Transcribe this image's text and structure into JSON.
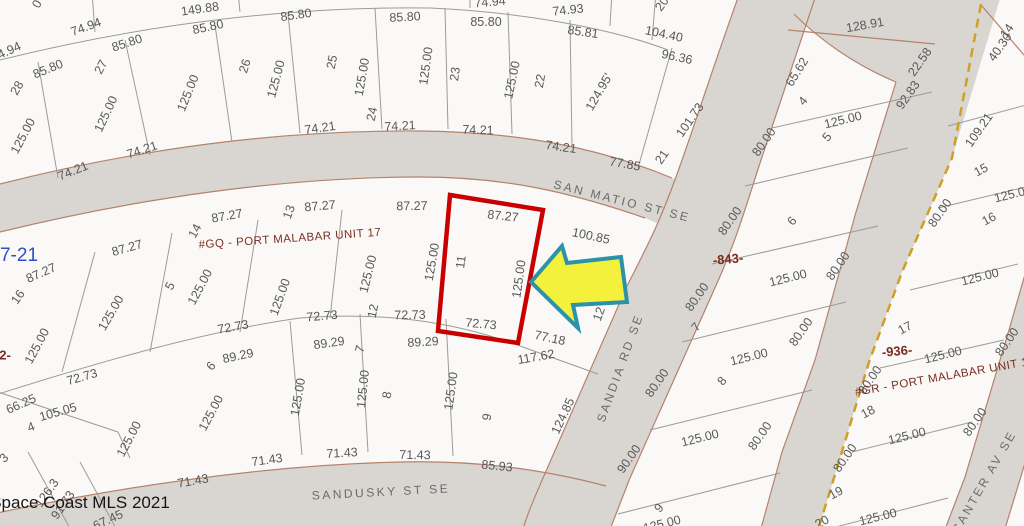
{
  "map": {
    "credit": "Space Coast MLS 2021",
    "plat_page_ref": "7-21",
    "streets": [
      "SAN MATIO ST SE",
      "SANDIA RD SE",
      "SANDUSKY ST SE",
      "CANTER AV SE"
    ],
    "subdivisions": [
      "#GQ - PORT MALABAR UNIT 17",
      "#GR - PORT MALABAR UNIT 18"
    ],
    "block_numbers": [
      "-843-",
      "-936-"
    ],
    "highlight": {
      "lot_number": "11",
      "top": "87.27",
      "left": "125.00",
      "right": "125.00",
      "bottom": "72.73"
    },
    "colors": {
      "parcel": "#faf9f7",
      "street": "#d9d6d2",
      "street_edge": "#b5826b",
      "highlight_red": "#c90000",
      "arrow_fill": "#f4f13c",
      "arrow_stroke": "#2c92a7",
      "boundary_dash": "#cf9f26"
    }
  },
  "labels": [
    {
      "t": "0",
      "x": 37,
      "y": 4,
      "r": -60
    },
    {
      "t": "149.88",
      "x": 200,
      "y": 9,
      "r": -8
    },
    {
      "t": "74.94",
      "x": 86,
      "y": 27,
      "r": -20
    },
    {
      "t": "74.94",
      "x": 490,
      "y": 2,
      "r": -5
    },
    {
      "t": "74.93",
      "x": 568,
      "y": 10,
      "r": -6
    },
    {
      "t": "85.81",
      "x": 583,
      "y": 32,
      "r": 8
    },
    {
      "t": "104.40",
      "x": 664,
      "y": 34,
      "r": 12
    },
    {
      "t": "96.36",
      "x": 677,
      "y": 57,
      "r": 12
    },
    {
      "t": "74.94",
      "x": 6,
      "y": 52,
      "r": -25
    },
    {
      "t": "85.80",
      "x": 48,
      "y": 69,
      "r": -22
    },
    {
      "t": "85.80",
      "x": 127,
      "y": 43,
      "r": -18
    },
    {
      "t": "85.80",
      "x": 208,
      "y": 27,
      "r": -12
    },
    {
      "t": "85.80",
      "x": 296,
      "y": 15,
      "r": -8
    },
    {
      "t": "85.80",
      "x": 405,
      "y": 17,
      "r": -3
    },
    {
      "t": "85.80",
      "x": 486,
      "y": 22,
      "r": 0
    },
    {
      "t": "28",
      "x": 17,
      "y": 88,
      "r": -60,
      "k": "lot"
    },
    {
      "t": "27",
      "x": 101,
      "y": 67,
      "r": -62,
      "k": "lot"
    },
    {
      "t": "26",
      "x": 245,
      "y": 66,
      "r": -72,
      "k": "lot"
    },
    {
      "t": "25",
      "x": 332,
      "y": 62,
      "r": -78,
      "k": "lot"
    },
    {
      "t": "24",
      "x": 372,
      "y": 114,
      "r": -78,
      "k": "lot"
    },
    {
      "t": "23",
      "x": 455,
      "y": 74,
      "r": -82,
      "k": "lot"
    },
    {
      "t": "22",
      "x": 540,
      "y": 81,
      "r": -80,
      "k": "lot"
    },
    {
      "t": "21",
      "x": 662,
      "y": 157,
      "r": -55,
      "k": "lot"
    },
    {
      "t": "20",
      "x": 662,
      "y": 4,
      "r": -55,
      "k": "lot"
    },
    {
      "t": "125.00",
      "x": 23,
      "y": 136,
      "r": -62
    },
    {
      "t": "125.00",
      "x": 106,
      "y": 114,
      "r": -65
    },
    {
      "t": "125.00",
      "x": 188,
      "y": 93,
      "r": -68
    },
    {
      "t": "125.00",
      "x": 276,
      "y": 79,
      "r": -75
    },
    {
      "t": "125.00",
      "x": 362,
      "y": 77,
      "r": -80
    },
    {
      "t": "125.00",
      "x": 426,
      "y": 66,
      "r": -82
    },
    {
      "t": "125.00",
      "x": 512,
      "y": 80,
      "r": -78
    },
    {
      "t": "124.95'",
      "x": 599,
      "y": 92,
      "r": -60
    },
    {
      "t": "101.73",
      "x": 690,
      "y": 120,
      "r": -55
    },
    {
      "t": "77.85",
      "x": 625,
      "y": 164,
      "r": 10
    },
    {
      "t": "74.21",
      "x": 73,
      "y": 171,
      "r": -22
    },
    {
      "t": "74.21",
      "x": 142,
      "y": 150,
      "r": -18
    },
    {
      "t": "74.21",
      "x": 320,
      "y": 128,
      "r": -8
    },
    {
      "t": "74.21",
      "x": 400,
      "y": 126,
      "r": -3
    },
    {
      "t": "74.21",
      "x": 478,
      "y": 130,
      "r": 2
    },
    {
      "t": "74.21",
      "x": 561,
      "y": 147,
      "r": 8
    },
    {
      "t": "SAN MATIO ST SE",
      "x": 622,
      "y": 201,
      "r": 14,
      "k": "street",
      "n": "street-label-san-matio-st-se"
    },
    {
      "t": "SANDIA RD SE",
      "x": 620,
      "y": 368,
      "r": -70,
      "k": "street",
      "n": "street-label-sandia-rd-se"
    },
    {
      "t": "SANDUSKY ST SE",
      "x": 381,
      "y": 492,
      "r": -3,
      "k": "street",
      "n": "street-label-sandusky-st-se"
    },
    {
      "t": "CANTER AV SE",
      "x": 984,
      "y": 482,
      "r": -60,
      "k": "street",
      "n": "street-label-canter-av-se"
    },
    {
      "t": "7-21",
      "x": 19,
      "y": 256,
      "r": 0,
      "k": "page",
      "n": "plat-page-ref"
    },
    {
      "t": "#GQ - PORT MALABAR UNIT 17",
      "x": 290,
      "y": 239,
      "r": -4,
      "k": "unit",
      "n": "subdivision-label-unit-17"
    },
    {
      "t": "87.27",
      "x": 41,
      "y": 273,
      "r": -24
    },
    {
      "t": "87.27",
      "x": 127,
      "y": 248,
      "r": -16
    },
    {
      "t": "87.27",
      "x": 227,
      "y": 216,
      "r": -10
    },
    {
      "t": "87.27",
      "x": 320,
      "y": 206,
      "r": -5
    },
    {
      "t": "87.27",
      "x": 412,
      "y": 206,
      "r": -1
    },
    {
      "t": "87.27",
      "x": 503,
      "y": 216,
      "r": 6
    },
    {
      "t": "100.85",
      "x": 591,
      "y": 236,
      "r": 12
    },
    {
      "t": "16",
      "x": 18,
      "y": 297,
      "r": -55,
      "k": "lot"
    },
    {
      "t": "5",
      "x": 170,
      "y": 286,
      "r": -62,
      "k": "lot"
    },
    {
      "t": "14",
      "x": 195,
      "y": 231,
      "r": -62,
      "k": "lot"
    },
    {
      "t": "13",
      "x": 289,
      "y": 212,
      "r": -70,
      "k": "lot"
    },
    {
      "t": "12",
      "x": 373,
      "y": 311,
      "r": -78,
      "k": "lot"
    },
    {
      "t": "11",
      "x": 461,
      "y": 262,
      "r": -82,
      "k": "lot",
      "n": "highlight-lot-number"
    },
    {
      "t": "125.00",
      "x": 111,
      "y": 313,
      "r": -60
    },
    {
      "t": "125.00",
      "x": 37,
      "y": 346,
      "r": -62
    },
    {
      "t": "125.00",
      "x": 200,
      "y": 287,
      "r": -62
    },
    {
      "t": "125.00",
      "x": 280,
      "y": 297,
      "r": -70
    },
    {
      "t": "125.00",
      "x": 368,
      "y": 274,
      "r": -76
    },
    {
      "t": "125.00",
      "x": 432,
      "y": 262,
      "r": -80
    },
    {
      "t": "125.00",
      "x": 519,
      "y": 279,
      "r": -82
    },
    {
      "t": "12",
      "x": 599,
      "y": 314,
      "r": -70
    },
    {
      "t": "72.73",
      "x": 82,
      "y": 377,
      "r": -16
    },
    {
      "t": "72.73",
      "x": 233,
      "y": 327,
      "r": -10
    },
    {
      "t": "72.73",
      "x": 322,
      "y": 316,
      "r": -5
    },
    {
      "t": "72.73",
      "x": 410,
      "y": 315,
      "r": -1
    },
    {
      "t": "72.73",
      "x": 481,
      "y": 324,
      "r": 5
    },
    {
      "t": "2-",
      "x": 5,
      "y": 355,
      "r": 0,
      "k": "block",
      "n": "block-number-left-partial"
    },
    {
      "t": "77.18",
      "x": 550,
      "y": 338,
      "r": 12
    },
    {
      "t": "117.62",
      "x": 536,
      "y": 357,
      "r": -10
    },
    {
      "t": "66.25",
      "x": 21,
      "y": 404,
      "r": -24
    },
    {
      "t": "105.05",
      "x": 58,
      "y": 412,
      "r": -16
    },
    {
      "t": "4",
      "x": 31,
      "y": 427,
      "r": -20,
      "k": "lot"
    },
    {
      "t": "3",
      "x": 4,
      "y": 458,
      "r": -45,
      "k": "lot"
    },
    {
      "t": "125.00",
      "x": 129,
      "y": 439,
      "r": -62
    },
    {
      "t": "89.29",
      "x": 238,
      "y": 356,
      "r": -12
    },
    {
      "t": "6",
      "x": 211,
      "y": 366,
      "r": -50,
      "k": "lot"
    },
    {
      "t": "125.00",
      "x": 211,
      "y": 413,
      "r": -62
    },
    {
      "t": "71.43",
      "x": 193,
      "y": 481,
      "r": -10
    },
    {
      "t": "126.3",
      "x": 47,
      "y": 493,
      "r": -55
    },
    {
      "t": "91.73",
      "x": 63,
      "y": 505,
      "r": -55
    },
    {
      "t": "67.45",
      "x": 108,
      "y": 520,
      "r": -25
    },
    {
      "t": "Space Coast MLS 2021",
      "x": 80,
      "y": 503,
      "r": 0,
      "k": "credit",
      "n": "mls-credit"
    },
    {
      "t": "89.29",
      "x": 329,
      "y": 343,
      "r": -8
    },
    {
      "t": "89.29",
      "x": 423,
      "y": 342,
      "r": -3
    },
    {
      "t": "7",
      "x": 360,
      "y": 349,
      "r": -75,
      "k": "lot"
    },
    {
      "t": "8",
      "x": 387,
      "y": 395,
      "r": -80,
      "k": "lot"
    },
    {
      "t": "9",
      "x": 487,
      "y": 417,
      "r": -80,
      "k": "lot"
    },
    {
      "t": "125.00",
      "x": 298,
      "y": 397,
      "r": -80
    },
    {
      "t": "125.00",
      "x": 363,
      "y": 389,
      "r": -84
    },
    {
      "t": "125.00",
      "x": 451,
      "y": 391,
      "r": -82
    },
    {
      "t": "71.43",
      "x": 267,
      "y": 460,
      "r": -8
    },
    {
      "t": "71.43",
      "x": 342,
      "y": 453,
      "r": -3
    },
    {
      "t": "71.43",
      "x": 415,
      "y": 455,
      "r": 1
    },
    {
      "t": "85.93",
      "x": 497,
      "y": 466,
      "r": 6
    },
    {
      "t": "124.85",
      "x": 563,
      "y": 416,
      "r": -65
    },
    {
      "t": "128.91",
      "x": 865,
      "y": 25,
      "r": -10
    },
    {
      "t": "22.58",
      "x": 920,
      "y": 62,
      "r": -55
    },
    {
      "t": "92.83",
      "x": 908,
      "y": 95,
      "r": -55
    },
    {
      "t": "65.62",
      "x": 797,
      "y": 72,
      "r": -58
    },
    {
      "t": "4",
      "x": 803,
      "y": 101,
      "r": -50,
      "k": "lot"
    },
    {
      "t": "125.00",
      "x": 843,
      "y": 120,
      "r": -14
    },
    {
      "t": "5",
      "x": 827,
      "y": 137,
      "r": -50,
      "k": "lot"
    },
    {
      "t": "80.00",
      "x": 764,
      "y": 142,
      "r": -55
    },
    {
      "t": "-843-",
      "x": 728,
      "y": 259,
      "r": -5,
      "k": "block",
      "n": "block-number-843"
    },
    {
      "t": "80.00",
      "x": 730,
      "y": 221,
      "r": -55
    },
    {
      "t": "6",
      "x": 792,
      "y": 221,
      "r": -50,
      "k": "lot"
    },
    {
      "t": "80.00",
      "x": 838,
      "y": 266,
      "r": -55
    },
    {
      "t": "125.00",
      "x": 788,
      "y": 278,
      "r": -14
    },
    {
      "t": "80.00",
      "x": 697,
      "y": 297,
      "r": -55
    },
    {
      "t": "7",
      "x": 696,
      "y": 327,
      "r": -50,
      "k": "lot"
    },
    {
      "t": "80.00",
      "x": 801,
      "y": 332,
      "r": -55
    },
    {
      "t": "125.00",
      "x": 749,
      "y": 357,
      "r": -14
    },
    {
      "t": "8",
      "x": 722,
      "y": 381,
      "r": -50,
      "k": "lot"
    },
    {
      "t": "80.00",
      "x": 657,
      "y": 383,
      "r": -55
    },
    {
      "t": "80.00",
      "x": 760,
      "y": 436,
      "r": -55
    },
    {
      "t": "125.00",
      "x": 700,
      "y": 438,
      "r": -14
    },
    {
      "t": "90.00",
      "x": 629,
      "y": 459,
      "r": -55
    },
    {
      "t": "9",
      "x": 659,
      "y": 508,
      "r": -50,
      "k": "lot"
    },
    {
      "t": "125.00",
      "x": 662,
      "y": 524,
      "r": -14
    },
    {
      "t": "14",
      "x": 1007,
      "y": 31,
      "r": -55,
      "k": "lot"
    },
    {
      "t": "40.30",
      "x": 1000,
      "y": 47,
      "r": -55
    },
    {
      "t": "109.21",
      "x": 979,
      "y": 130,
      "r": -55
    },
    {
      "t": "15",
      "x": 981,
      "y": 170,
      "r": -28,
      "k": "lot"
    },
    {
      "t": "125.00",
      "x": 1013,
      "y": 194,
      "r": -14
    },
    {
      "t": "16",
      "x": 989,
      "y": 219,
      "r": -28,
      "k": "lot"
    },
    {
      "t": "80.00",
      "x": 940,
      "y": 213,
      "r": -55
    },
    {
      "t": "125.00",
      "x": 980,
      "y": 277,
      "r": -14
    },
    {
      "t": "17",
      "x": 905,
      "y": 328,
      "r": -28,
      "k": "lot"
    },
    {
      "t": "80.00",
      "x": 1007,
      "y": 342,
      "r": -55
    },
    {
      "t": "-936-",
      "x": 897,
      "y": 351,
      "r": -5,
      "k": "block",
      "n": "block-number-936"
    },
    {
      "t": "125.00",
      "x": 943,
      "y": 355,
      "r": -14
    },
    {
      "t": "80.00",
      "x": 870,
      "y": 380,
      "r": -55
    },
    {
      "t": "#GR - PORT MALABAR UNIT 18",
      "x": 945,
      "y": 377,
      "r": -10,
      "k": "unit",
      "n": "subdivision-label-unit-18"
    },
    {
      "t": "18",
      "x": 868,
      "y": 412,
      "r": -28,
      "k": "lot"
    },
    {
      "t": "80.00",
      "x": 975,
      "y": 422,
      "r": -55
    },
    {
      "t": "125.00",
      "x": 907,
      "y": 436,
      "r": -14
    },
    {
      "t": "80.00",
      "x": 845,
      "y": 458,
      "r": -55
    },
    {
      "t": "19",
      "x": 836,
      "y": 493,
      "r": -28,
      "k": "lot"
    },
    {
      "t": "125.00",
      "x": 878,
      "y": 517,
      "r": -14
    },
    {
      "t": "20",
      "x": 822,
      "y": 522,
      "r": -28,
      "k": "lot"
    }
  ]
}
